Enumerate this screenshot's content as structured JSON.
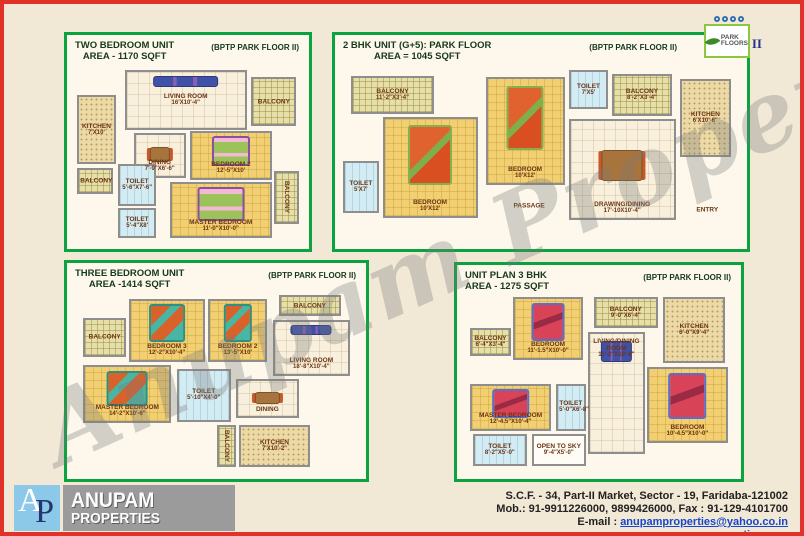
{
  "page": {
    "watermark": "Anupam Properties"
  },
  "colors": {
    "border_red": "#e03228",
    "panel_green": "#0aa33f",
    "link_blue": "#1546cc"
  },
  "park_logo": {
    "line1": "PARK",
    "line2": "FLOORS",
    "suffix": "II"
  },
  "footer": {
    "logo_letter_a": "A",
    "logo_letter_p": "P",
    "logo_line1": "ANUPAM",
    "logo_line2": "PROPERTIES",
    "address": "S.C.F. - 34, Part-II Market, Sector - 19, Faridaba-121002",
    "phones": "Mob.: 91-9911226000, 9899426000, Fax : 91-129-4101700",
    "email_label": "E-mail : ",
    "email": "anupamproperties@yahoo.co.in",
    "website": "www.anupamproperties.com"
  },
  "panels": [
    {
      "id": "two-bedroom",
      "title1": "TWO BEDROOM UNIT",
      "title2": "AREA - 1170 SQFT",
      "brand": "(BPTP PARK FLOOR II)",
      "rooms": [
        {
          "key": "living",
          "name": "LIVING ROOM",
          "dims": "16'X10'-4\""
        },
        {
          "key": "balcony_r1",
          "name": "BALCONY",
          "dims": ""
        },
        {
          "key": "kitchen",
          "name": "KITCHEN",
          "dims": "7'X10'"
        },
        {
          "key": "dining",
          "name": "DINING",
          "dims": "7'-9\"X6'-6\""
        },
        {
          "key": "bedroom2",
          "name": "BEDROOM 2",
          "dims": "12'-5\"X10'"
        },
        {
          "key": "balcony_l",
          "name": "BALCONY",
          "dims": ""
        },
        {
          "key": "toilet1",
          "name": "TOILET",
          "dims": "5'-6\"X7'-6\""
        },
        {
          "key": "toilet2",
          "name": "TOILET",
          "dims": "5'-4\"X8'"
        },
        {
          "key": "master",
          "name": "MASTER BEDROOM",
          "dims": "11'-0\"X10'-0\""
        },
        {
          "key": "balcony_r2",
          "name": "BALCONY",
          "dims": ""
        }
      ]
    },
    {
      "id": "2bhk",
      "title1": "2 BHK UNIT (G+5): PARK FLOOR",
      "title2": "AREA = 1045 SQFT",
      "brand": "(BPTP PARK FLOOR II)",
      "rooms": [
        {
          "key": "balcony1",
          "name": "BALCONY",
          "dims": "11'-2\"X3'-4\""
        },
        {
          "key": "bedroom1",
          "name": "BEDROOM",
          "dims": "10'X12'"
        },
        {
          "key": "toilet1",
          "name": "TOILET",
          "dims": "5'X7'"
        },
        {
          "key": "bedroom2",
          "name": "BEDROOM",
          "dims": "10'X12'"
        },
        {
          "key": "toilet2",
          "name": "TOILET",
          "dims": "7'X5'"
        },
        {
          "key": "balcony2",
          "name": "BALCONY",
          "dims": "8'-2\"X3'-4\""
        },
        {
          "key": "kitchen",
          "name": "KITCHEN",
          "dims": "6'X10'-6\""
        },
        {
          "key": "drawing",
          "name": "DRAWING/DINING",
          "dims": "17'-10X10'-4\""
        },
        {
          "key": "passage",
          "name": "PASSAGE",
          "dims": ""
        },
        {
          "key": "entry",
          "name": "ENTRY",
          "dims": ""
        }
      ]
    },
    {
      "id": "three-bedroom",
      "title1": "THREE BEDROOM UNIT",
      "title2": "AREA -1414 SQFT",
      "brand": "(BPTP PARK FLOOR II)",
      "rooms": [
        {
          "key": "balcony_l",
          "name": "BALCONY",
          "dims": ""
        },
        {
          "key": "bedroom3",
          "name": "BEDROOM 3",
          "dims": "12'-2\"X10'-4\""
        },
        {
          "key": "bedroom2",
          "name": "BEDROOM 2",
          "dims": "13'-5\"X10'"
        },
        {
          "key": "balcony_tr",
          "name": "BALCONY",
          "dims": ""
        },
        {
          "key": "living",
          "name": "LIVING ROOM",
          "dims": "18'-8\"X10'-4\""
        },
        {
          "key": "master",
          "name": "MASTER BEDROOM",
          "dims": "14'-2\"X10'-6\""
        },
        {
          "key": "toilet",
          "name": "TOILET",
          "dims": "5'-10\"X4'-0\""
        },
        {
          "key": "dining",
          "name": "DINING",
          "dims": ""
        },
        {
          "key": "kitchen",
          "name": "KITCHEN",
          "dims": "7'X10'-2\""
        },
        {
          "key": "balcony_b",
          "name": "BALCONY",
          "dims": ""
        }
      ]
    },
    {
      "id": "unit-3bhk",
      "title1": "UNIT PLAN 3 BHK",
      "title2": "AREA - 1275 SQFT",
      "brand": "(BPTP PARK FLOOR II)",
      "rooms": [
        {
          "key": "bedroom1",
          "name": "BEDROOM",
          "dims": "11'-1.5\"X10'-0\""
        },
        {
          "key": "balcony_l",
          "name": "BALCONY",
          "dims": "6'-4\"X3'-4\""
        },
        {
          "key": "balcony_t",
          "name": "BALCONY",
          "dims": "9'-0\"X6'-4\""
        },
        {
          "key": "kitchen",
          "name": "KITCHEN",
          "dims": "6'-0\"X9'-4\""
        },
        {
          "key": "bedroom2",
          "name": "BEDROOM",
          "dims": "10'-4.5\"X10'-0\""
        },
        {
          "key": "livingdining",
          "name": "LIVING/DINING ROOM",
          "dims": "11'-2\"X19'-8\""
        },
        {
          "key": "master",
          "name": "MASTER BEDROOM",
          "dims": "12'-4.5\"X10'-4\""
        },
        {
          "key": "toilet1",
          "name": "TOILET",
          "dims": "5'-0\"X6'-8\""
        },
        {
          "key": "toilet2",
          "name": "TOILET",
          "dims": "8'-2\"X5'-0\""
        },
        {
          "key": "open_sky",
          "name": "OPEN TO SKY",
          "dims": "9'-4\"X5'-0\""
        }
      ]
    }
  ]
}
